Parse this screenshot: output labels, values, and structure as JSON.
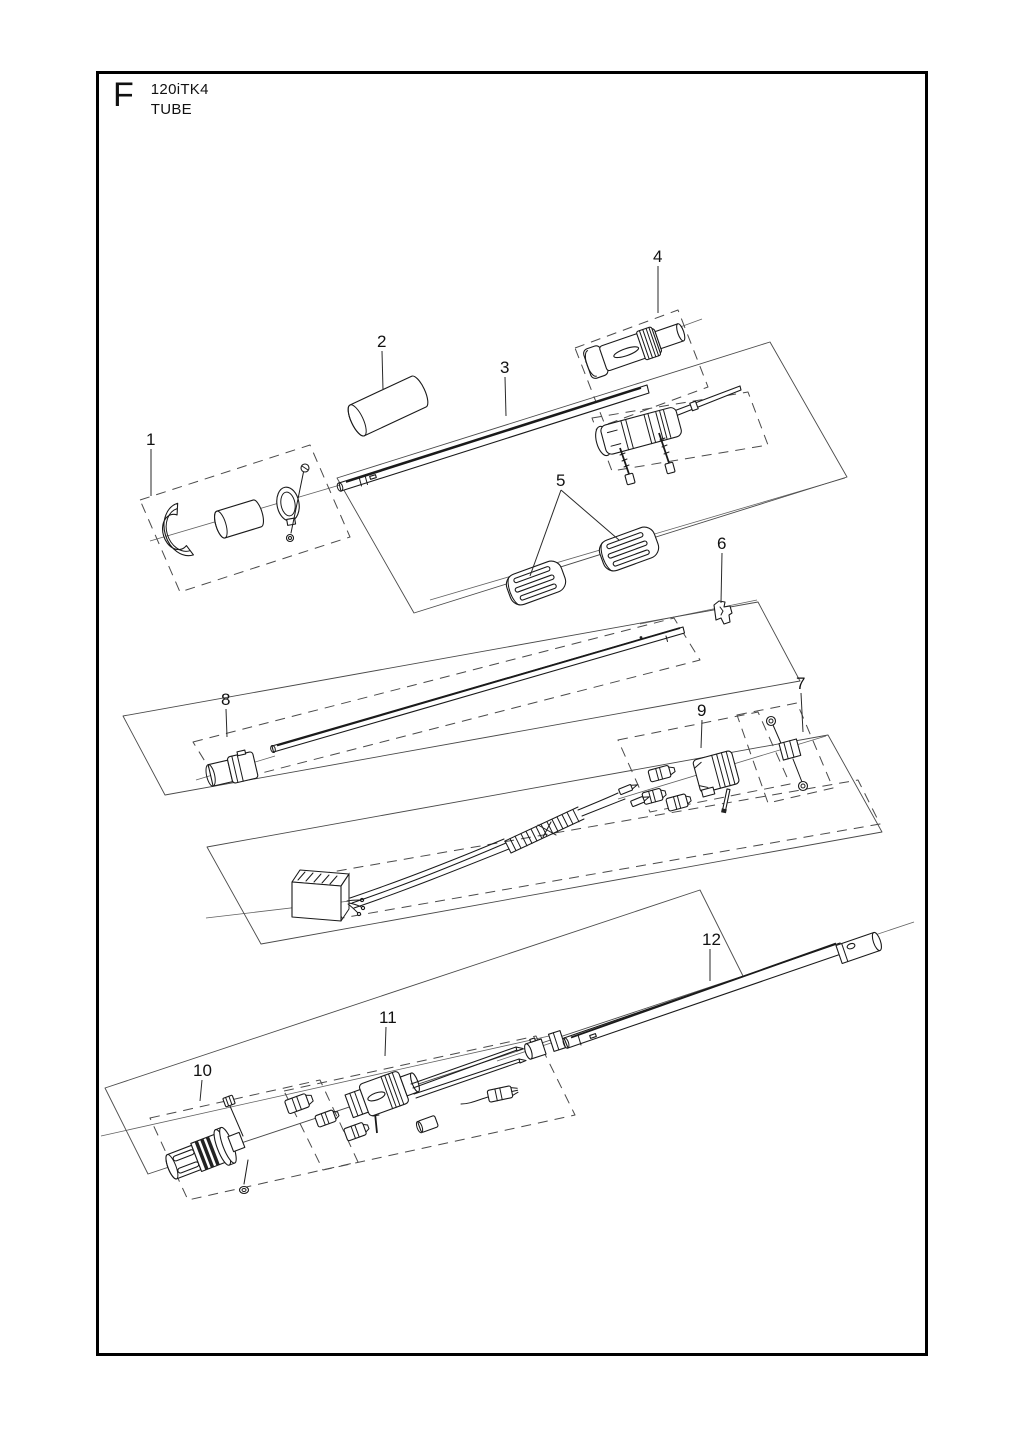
{
  "header": {
    "figure_letter": "F",
    "model": "120iTK4",
    "section": "TUBE"
  },
  "diagram": {
    "kind": "exploded-parts-diagram",
    "part_count": 12
  },
  "callouts": [
    {
      "label": "1"
    },
    {
      "label": "2"
    },
    {
      "label": "3"
    },
    {
      "label": "4"
    },
    {
      "label": "5"
    },
    {
      "label": "6"
    },
    {
      "label": "7"
    },
    {
      "label": "8"
    },
    {
      "label": "9"
    },
    {
      "label": "10"
    },
    {
      "label": "11"
    },
    {
      "label": "12"
    }
  ],
  "colors": {
    "line": "#1a1a1a",
    "construction": "#606060",
    "frame": "#000000",
    "background": "#ffffff"
  }
}
